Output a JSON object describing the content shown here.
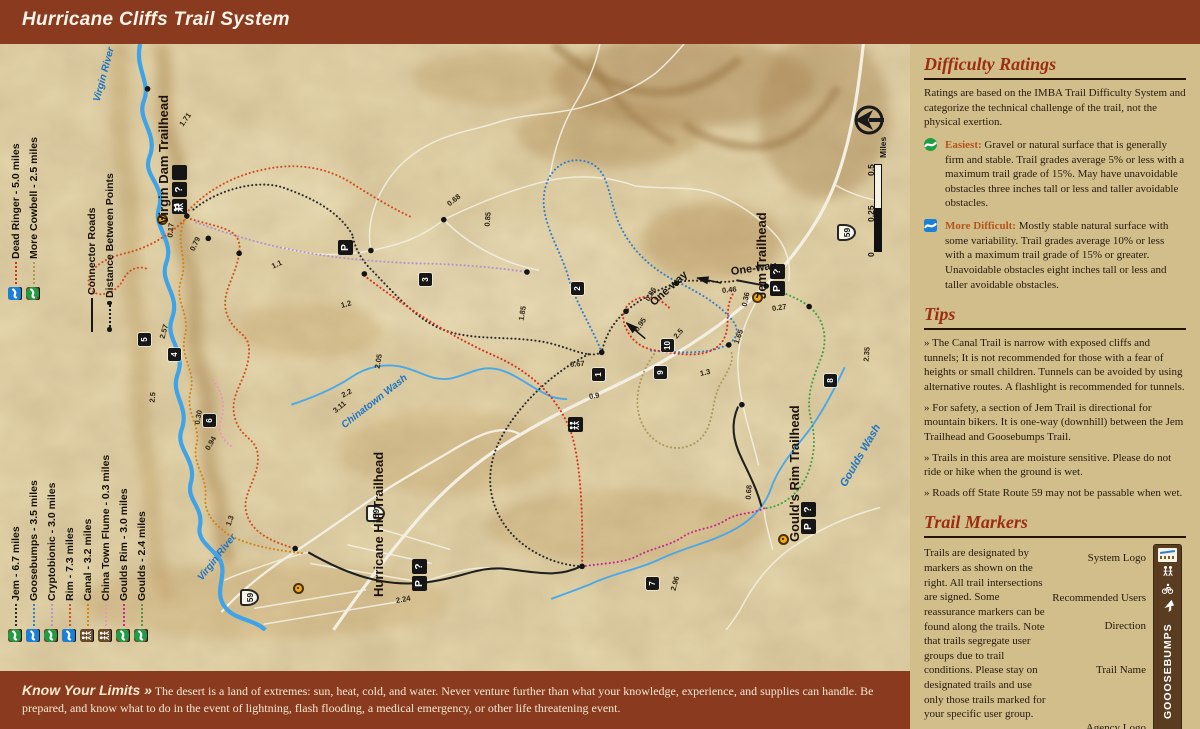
{
  "header": {
    "title": "Hurricane Cliffs Trail System"
  },
  "colors": {
    "header_bar": "#8a3a1e",
    "sidebar_bg": "#d2be8a",
    "heading_red": "#9c2d12",
    "easiest": "#1f9d44",
    "more_difficult": "#1a7fd6",
    "river_blue": "#3fa3e8",
    "user_icon_brown": "#6b4a26",
    "marker_black": "#171717",
    "trailhead_dot": "#f2a71b"
  },
  "legend": {
    "connector_label": "Connector Roads",
    "distance_label": "Distance Between Points",
    "trails": [
      {
        "num": "1",
        "label": "Jem - 6.7 miles",
        "color": "#2b2b2b",
        "difficulty": "easiest",
        "users": [
          "hikers",
          "bike"
        ],
        "group": "bottom"
      },
      {
        "num": "2",
        "label": "Goosebumps -  3.5 miles",
        "color": "#2f7fd0",
        "difficulty": "more_difficult",
        "users": [
          "hikers",
          "bike"
        ],
        "group": "bottom"
      },
      {
        "num": "3",
        "label": "Cryptobionic - 3.0 miles",
        "color": "#b493cf",
        "difficulty": "easiest",
        "users": [
          "hikers",
          "bike"
        ],
        "group": "bottom"
      },
      {
        "num": "4",
        "label": "Rim - 7.3 miles",
        "color": "#d2501f",
        "difficulty": "more_difficult",
        "users": [
          "horse",
          "hikers",
          "bike"
        ],
        "group": "bottom"
      },
      {
        "num": "5",
        "label": "Canal - 3.2 miles",
        "color": "#d58310",
        "difficulty": null,
        "users": [
          "hikers"
        ],
        "group": "bottom"
      },
      {
        "num": "6",
        "label": "China Town Flume - 0.3 miles",
        "color": "#f094bb",
        "difficulty": null,
        "users": [
          "hikers"
        ],
        "group": "bottom"
      },
      {
        "num": "7",
        "label": "Goulds Rim - 3.0 miles",
        "color": "#c42c90",
        "difficulty": "easiest",
        "users": [
          "hikers",
          "bike"
        ],
        "group": "bottom"
      },
      {
        "num": "8",
        "label": "Goulds - 2.4 miles",
        "color": "#41a046",
        "difficulty": "easiest",
        "users": [
          "hikers",
          "bike"
        ],
        "group": "bottom"
      },
      {
        "num": "9",
        "label": "Dead Ringer - 5.0 miles",
        "color": "#d63020",
        "difficulty": "more_difficult",
        "users": [
          "bike_hiker"
        ],
        "group": "top"
      },
      {
        "num": "10",
        "label": "More Cowbell - 2.5 miles",
        "color": "#ab9a58",
        "difficulty": "easiest",
        "users": [
          "bike_hiker"
        ],
        "group": "top"
      }
    ]
  },
  "map": {
    "one_way_label": "One-way",
    "shield_label": "59",
    "scale": {
      "ticks": [
        "0",
        "0.25",
        "0.5"
      ],
      "unit": "Miles"
    },
    "trailheads": [
      {
        "name": "Virgin Dam Trailhead",
        "dot": [
          162,
          219
        ],
        "label_pos": [
          156,
          224
        ],
        "icons": [
          "parking",
          "info",
          "restroom"
        ],
        "icons_pos": [
          172,
          214
        ]
      },
      {
        "name": "Jem Trailhead",
        "dot": [
          757,
          297
        ],
        "label_pos": [
          754,
          299
        ],
        "icons": [
          "parking",
          "info"
        ],
        "icons_pos": [
          770,
          296
        ]
      },
      {
        "name": "Hurricane Hill Trailhead",
        "dot": [
          298,
          588
        ],
        "label_pos": [
          371,
          597
        ],
        "icons": [
          "parking",
          "info"
        ],
        "icons_pos": [
          412,
          591
        ]
      },
      {
        "name": "Gould's Rim Trailhead",
        "dot": [
          783,
          539
        ],
        "label_pos": [
          787,
          542
        ],
        "icons": [
          "parking",
          "info"
        ],
        "icons_pos": [
          801,
          534
        ]
      }
    ],
    "markers": [
      {
        "n": "1",
        "x": 598,
        "y": 374
      },
      {
        "n": "2",
        "x": 577,
        "y": 288
      },
      {
        "n": "3",
        "x": 425,
        "y": 279
      },
      {
        "n": "4",
        "x": 174,
        "y": 354
      },
      {
        "n": "5",
        "x": 144,
        "y": 339
      },
      {
        "n": "6",
        "x": 209,
        "y": 420
      },
      {
        "n": "7",
        "x": 652,
        "y": 583
      },
      {
        "n": "8",
        "x": 830,
        "y": 380
      },
      {
        "n": "9",
        "x": 660,
        "y": 372
      },
      {
        "n": "10",
        "x": 667,
        "y": 345
      }
    ],
    "facilities": [
      {
        "type": "restroom",
        "x": 575,
        "y": 424
      },
      {
        "type": "parking",
        "x": 345,
        "y": 247
      }
    ],
    "shields": [
      {
        "x": 846,
        "y": 232
      },
      {
        "x": 375,
        "y": 513
      },
      {
        "x": 249,
        "y": 597
      }
    ],
    "one_way": [
      {
        "x": 731,
        "y": 266,
        "rot": -8,
        "ax": 698,
        "ay": 272,
        "arot": 12
      },
      {
        "x": 652,
        "y": 298,
        "rot": -42,
        "ax": 630,
        "ay": 318,
        "arot": 40
      }
    ],
    "distances": [
      {
        "t": "0.17",
        "x": 170,
        "y": 233,
        "r": -85
      },
      {
        "t": "0.79",
        "x": 192,
        "y": 246,
        "r": -65
      },
      {
        "t": "1.71",
        "x": 181,
        "y": 121,
        "r": -55
      },
      {
        "t": "1.1",
        "x": 272,
        "y": 262,
        "r": -25
      },
      {
        "t": "1.2",
        "x": 341,
        "y": 301,
        "r": -15
      },
      {
        "t": "2.57",
        "x": 162,
        "y": 334,
        "r": -75
      },
      {
        "t": "2.5",
        "x": 152,
        "y": 398,
        "r": -85
      },
      {
        "t": "0.30",
        "x": 197,
        "y": 420,
        "r": -80
      },
      {
        "t": "0.94",
        "x": 207,
        "y": 445,
        "r": -60
      },
      {
        "t": "1.3",
        "x": 228,
        "y": 521,
        "r": -70
      },
      {
        "t": "2.2",
        "x": 342,
        "y": 391,
        "r": -28
      },
      {
        "t": "2.05",
        "x": 377,
        "y": 364,
        "r": -80
      },
      {
        "t": "0.68",
        "x": 448,
        "y": 200,
        "r": -38
      },
      {
        "t": "0.85",
        "x": 487,
        "y": 222,
        "r": -85
      },
      {
        "t": "1.85",
        "x": 521,
        "y": 316,
        "r": -80
      },
      {
        "t": "0.67",
        "x": 570,
        "y": 360,
        "r": -5
      },
      {
        "t": "0.9",
        "x": 589,
        "y": 392,
        "r": -8
      },
      {
        "t": "0.95",
        "x": 636,
        "y": 326,
        "r": -55
      },
      {
        "t": "2.5",
        "x": 675,
        "y": 333,
        "r": -50
      },
      {
        "t": "1.3",
        "x": 700,
        "y": 369,
        "r": -12
      },
      {
        "t": "1.65",
        "x": 736,
        "y": 339,
        "r": -70
      },
      {
        "t": "0.46",
        "x": 722,
        "y": 286,
        "r": -6
      },
      {
        "t": "0.36",
        "x": 744,
        "y": 302,
        "r": -78
      },
      {
        "t": "0.27",
        "x": 772,
        "y": 304,
        "r": -8
      },
      {
        "t": "0.86",
        "x": 647,
        "y": 296,
        "r": -60
      },
      {
        "t": "2.35",
        "x": 866,
        "y": 357,
        "r": -85
      },
      {
        "t": "0.68",
        "x": 748,
        "y": 495,
        "r": -85
      },
      {
        "t": "2.96",
        "x": 673,
        "y": 586,
        "r": -75
      },
      {
        "t": "2.24",
        "x": 396,
        "y": 596,
        "r": -10
      },
      {
        "t": "3.11",
        "x": 334,
        "y": 407,
        "r": -40
      }
    ],
    "water_labels": [
      {
        "t": "Virgin River",
        "x": 97,
        "y": 96,
        "r": -75,
        "s": 10
      },
      {
        "t": "Virgin River",
        "x": 200,
        "y": 574,
        "r": -52,
        "s": 10
      },
      {
        "t": "Chinatown Wash",
        "x": 343,
        "y": 421,
        "r": -38,
        "s": 10
      },
      {
        "t": "Goulds Wash",
        "x": 843,
        "y": 480,
        "r": -60,
        "s": 11
      }
    ]
  },
  "sidebar": {
    "difficulty": {
      "title": "Difficulty Ratings",
      "intro": "Ratings are based on the IMBA Trail Difficulty System and categorize the technical challenge of the trail, not the physical exertion.",
      "levels": [
        {
          "name": "Easiest:",
          "type": "easiest",
          "desc": "Gravel or natural surface that is generally firm and stable. Trail grades average 5% or less with a maximum trail grade of 15%. May have unavoidable obstacles three inches tall or less and taller avoidable obstacles."
        },
        {
          "name": "More Difficult:",
          "type": "more_difficult",
          "desc": "Mostly stable natural surface with some variability. Trail grades average 10% or less with a maximum trail grade of 15% or greater. Unavoidable obstacles eight inches tall or less and taller avoidable obstacles."
        }
      ]
    },
    "tips": {
      "title": "Tips",
      "items": [
        "» The Canal Trail is narrow with exposed cliffs and tunnels; It is not recommended for those with a fear of heights or small children. Tunnels can be avoided by using alternative routes. A flashlight is recommended for tunnels.",
        "» For safety, a section of Jem Trail is directional for mountain bikers. It is one-way (downhill) between the Jem Trailhead and Goosebumps Trail.",
        "» Trails in this area are moisture sensitive. Please do not ride or hike when the ground is wet.",
        "» Roads off State Route 59 may not be passable when wet."
      ]
    },
    "trail_markers": {
      "title": "Trail Markers",
      "body": "Trails are designated by markers as shown on the right. All trail intersections are signed. Some reassurance markers can be found along the trails. Note that trails segregate user groups due to trail conditions. Please stay on designated trails and use only those trails marked for your specific user group.",
      "labels": [
        "System Logo",
        "Recommended Users",
        "Direction",
        "Trail Name",
        "Agency Logo"
      ],
      "post_text": "GOOOSEBUMPS"
    }
  },
  "footer": {
    "title": "Know Your Limits »",
    "text": "The desert is a land of extremes: sun, heat, cold, and water.  Never venture further than what your knowledge, experience, and supplies can handle.  Be prepared, and know what to do in the event of lightning, flash flooding, a medical emergency, or other life threatening event."
  }
}
